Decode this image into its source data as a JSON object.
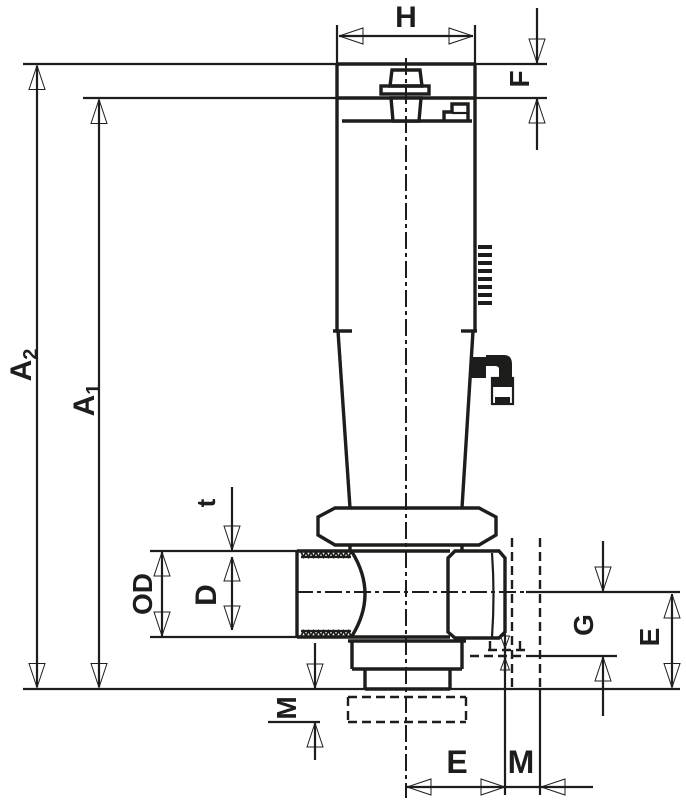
{
  "meta": {
    "background": "#ffffff",
    "ink_color": "#1d1d1b",
    "drawing_type": "dimensional engineering drawing of a sampling valve"
  },
  "labels": {
    "width_top": "H",
    "cap_height": "F",
    "height_outer": {
      "base": "A",
      "sub": "2"
    },
    "height_inner": {
      "base": "A",
      "sub": "1"
    },
    "wall_thickness": "t",
    "outer_diameter": "OD",
    "bore_diameter": "D",
    "nut_projection": "M",
    "center_to_face": "E",
    "face_to_thread_end": "M",
    "center_to_drain": "G",
    "center_to_bottom": "E"
  }
}
